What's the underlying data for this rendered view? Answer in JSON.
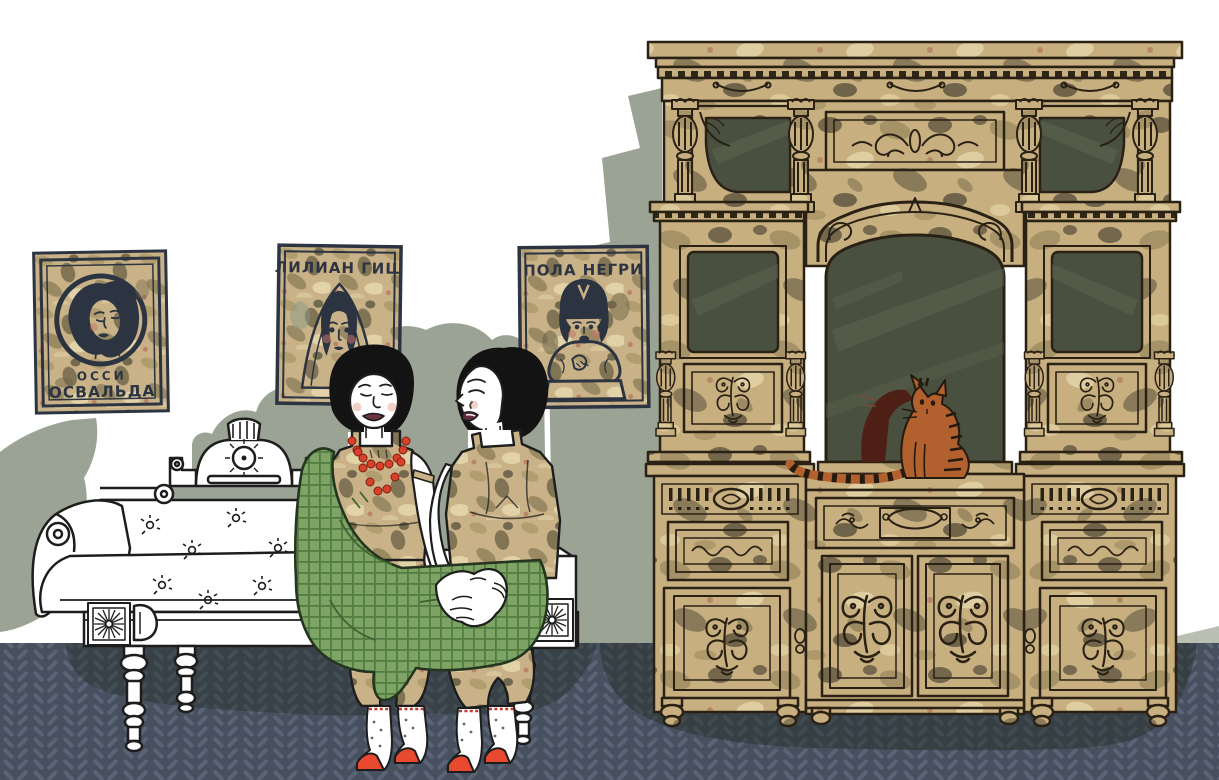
{
  "artwork": {
    "type": "illustration-interior-scene",
    "posters": [
      {
        "id": "ossi-oswalda",
        "line1": "ОССИ",
        "line2": "ОСВАЛЬДА"
      },
      {
        "id": "lillian-gish",
        "title": "ЛИЛИАН ГИШ"
      },
      {
        "id": "pola-negri",
        "title": "ПОЛА НЕГРИ"
      }
    ],
    "objects": [
      "two women seated on white chaise lounge holding hands",
      "green plaid blanket",
      "ornate gold mirrored cabinet",
      "orange tabby cat on cabinet ledge with mirror reflection",
      "three vintage film-star posters",
      "dark herringbone carpet"
    ],
    "palette": {
      "wall": "#ffffff",
      "wall_shadow": "#9ba494",
      "floor": "#47505f",
      "floor_pattern": "#5b6476",
      "gold": "#c9b287",
      "gold_dark": "#6e6448",
      "poster_ink": "#2c3442",
      "mirror_glass": "#4a5040",
      "blanket_green": "#7ea465",
      "blanket_grid": "#527c41",
      "cat_orange": "#b2602d",
      "cat_reflection": "#4e1c13",
      "accent_red": "#d9402a",
      "outline": "#1d1d1d"
    }
  }
}
